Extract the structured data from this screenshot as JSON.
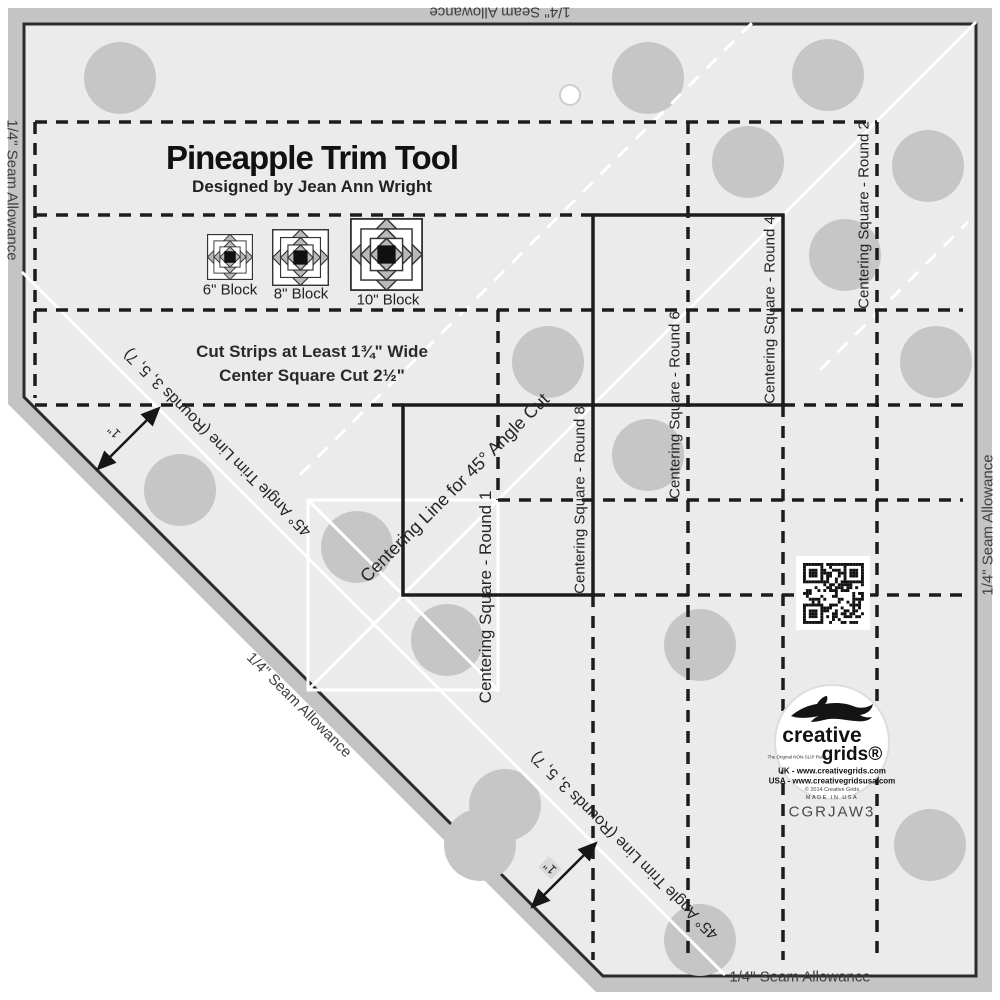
{
  "header": {
    "title": "Pineapple Trim Tool",
    "subtitle": "Designed by Jean Ann Wright"
  },
  "blocks": {
    "b6": "6\" Block",
    "b8": "8\" Block",
    "b10": "10\" Block"
  },
  "instructions": {
    "line1": "Cut Strips at Least 1¾\" Wide",
    "line2": "Center Square Cut 2½\""
  },
  "centering": {
    "round1": "Centering Square - Round 1",
    "round2": "Centering Square - Round 2",
    "round4": "Centering Square - Round 4",
    "round6": "Centering Square - Round 6",
    "round8": "Centering Square - Round 8",
    "line45": "Centering Line for 45° Angle Cut"
  },
  "trim": {
    "label": "45° Angle Trim Line (Rounds 3, 5, 7)",
    "inch": "1\""
  },
  "seam": {
    "label": "1/4\" Seam Allowance"
  },
  "branding": {
    "name_top": "creative",
    "name_bottom": "grids®",
    "tagline": "The Original NON-SLIP Ruler",
    "uk": "UK - www.creativegrids.com",
    "usa": "USA - www.creativegridsusa.com",
    "copyright": "© 2014 Creative Grids",
    "made": "MADE IN USA",
    "sku": "CGRJAW3"
  },
  "colors": {
    "ruler": "#ebebeb",
    "band": "#c4c4c4",
    "outline": "#2b2b2b",
    "dots": "#c6c6c6",
    "mark_black": "#1c1c1c",
    "mark_white": "#ffffff"
  }
}
